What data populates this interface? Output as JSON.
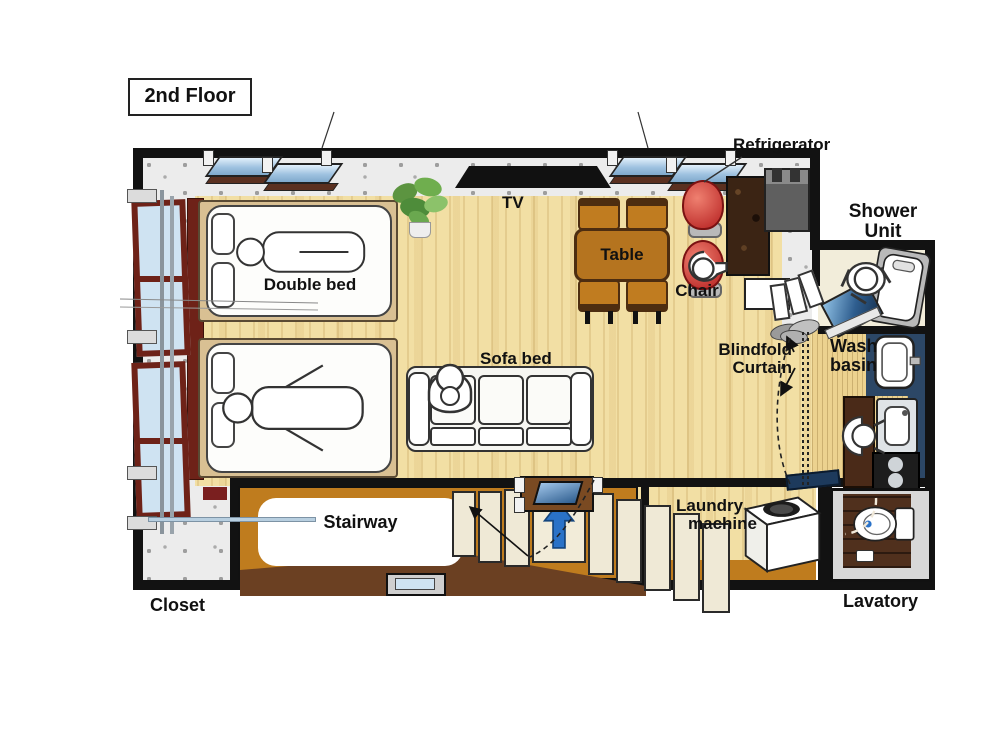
{
  "title": "2nd Floor",
  "labels": {
    "tv": "TV",
    "table": "Table",
    "chair": "Chair",
    "refrigerator": "Refrigerator",
    "shower_unit": [
      "Shower",
      "Unit"
    ],
    "wash_basin": [
      "Wash",
      "basin"
    ],
    "blindfold_curtain": [
      "Blindfold",
      "Curtain"
    ],
    "double_bed": "Double bed",
    "sofa_bed": "Sofa bed",
    "stairway": "Stairway",
    "laundry_machine": [
      "Laundry",
      "machine"
    ],
    "lavatory": "Lavatory",
    "closet": "Closet"
  },
  "colors": {
    "wall": "#121212",
    "wood_floor": "#f2dfa4",
    "stair_block": "#bf7c1e",
    "stair_ramp": "#6b4022",
    "counter_brown": "#3b2414",
    "chair_red": "#c22323",
    "table_brown": "#b5741f",
    "window_glass": "#cfe3f2",
    "window_frame": "#6e2218",
    "arrow_blue": "#2a72c8",
    "navy_panel": "#2c4766",
    "lavatory_floor": "#50301d",
    "shower_floor": "#f2edda",
    "concrete_gray": "#ececec"
  }
}
